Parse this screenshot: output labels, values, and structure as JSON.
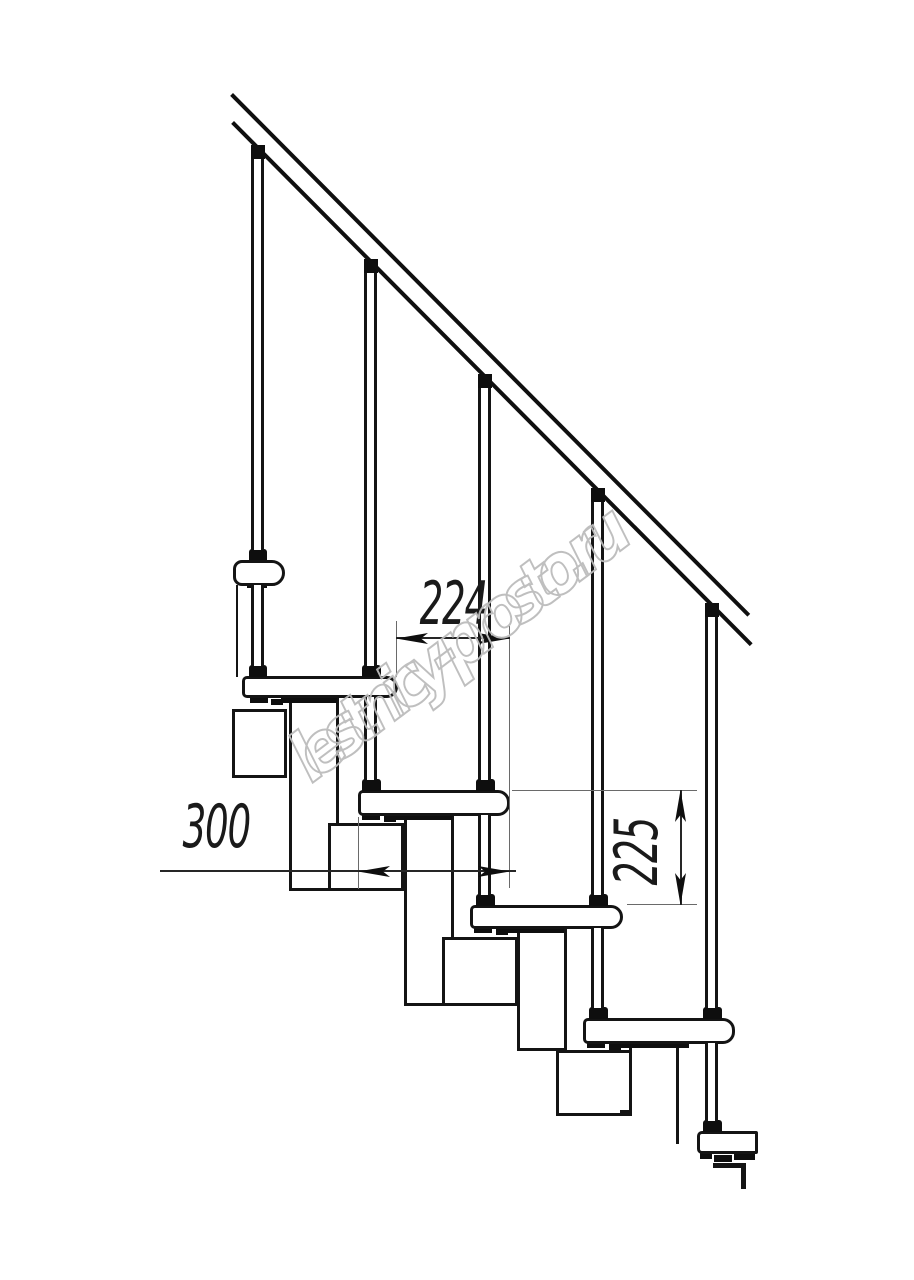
{
  "drawing": {
    "description": "modular staircase side elevation fragment",
    "dimensions": {
      "run": "224",
      "depth": "300",
      "rise": "225"
    },
    "watermark": {
      "text": "lestnicy-prosto.ru",
      "color": "#bcbcbc"
    },
    "colors": {
      "outline": "#141414",
      "dimension_line": "#262626",
      "extension_line": "#6a6a6a",
      "background": "#ffffff"
    }
  }
}
